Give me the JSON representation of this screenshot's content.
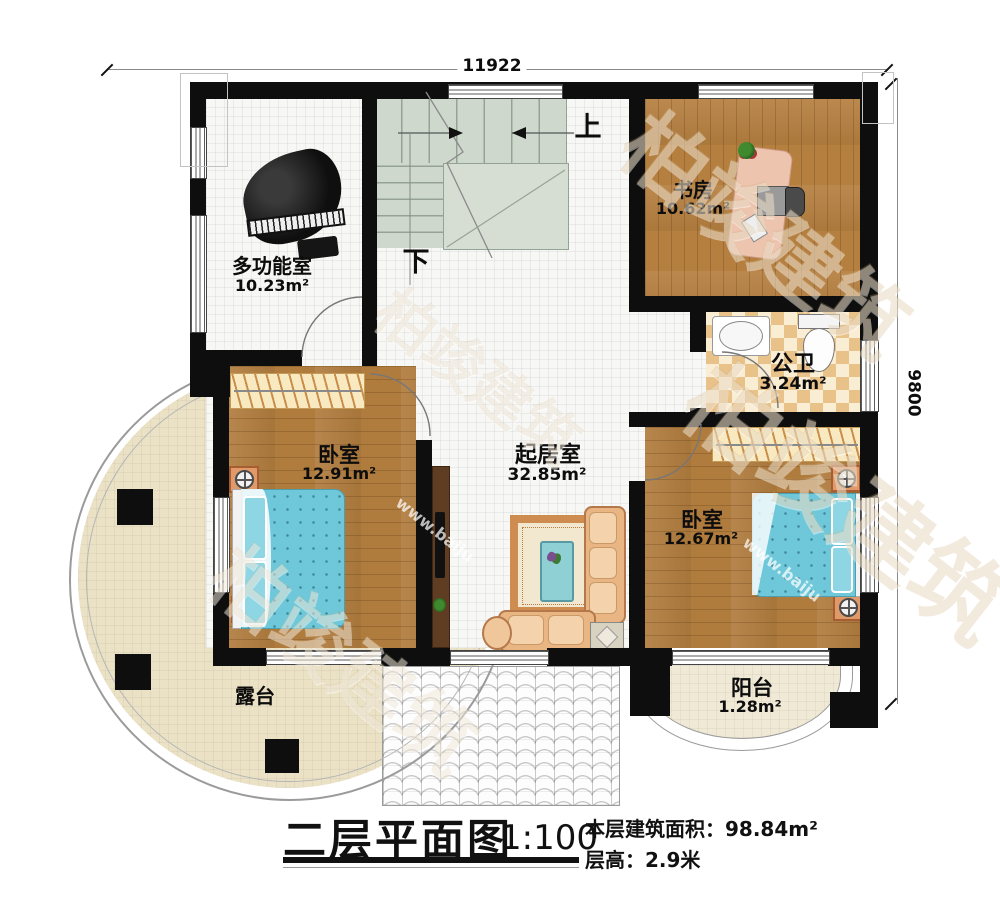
{
  "dimensions": {
    "width_label": "11922",
    "height_label": "9800"
  },
  "stairs": {
    "up": "上",
    "down": "下"
  },
  "rooms": {
    "multi_function": {
      "name": "多功能室",
      "area": "10.23m²"
    },
    "study": {
      "name": "书房",
      "area": "10.62m²"
    },
    "bathroom": {
      "name": "公卫",
      "area": "3.24m²"
    },
    "bedroom_left": {
      "name": "卧室",
      "area": "12.91m²"
    },
    "living_room": {
      "name": "起居室",
      "area": "32.85m²"
    },
    "bedroom_right": {
      "name": "卧室",
      "area": "12.67m²"
    },
    "terrace": {
      "name": "露台"
    },
    "balcony": {
      "name": "阳台",
      "area": "1.28m²"
    }
  },
  "title_block": {
    "title": "二层平面图",
    "scale": "1:100",
    "building_area": "本层建筑面积：98.84m²",
    "floor_height": "层高：2.9米"
  },
  "watermark": {
    "brand": "柏竣建筑",
    "url": "www.baiju"
  },
  "colors": {
    "wall": "#0e0e0e",
    "wood_floor": "#b07c3e",
    "tile_floor": "#f7f7f5",
    "stair": "#cfd8cd",
    "bath_checker": "#e9c28a",
    "terrace": "#ebe2c6",
    "bed": "#6fc8d9",
    "sofa": "#e8b583",
    "nightstand": "#e09a6a"
  }
}
